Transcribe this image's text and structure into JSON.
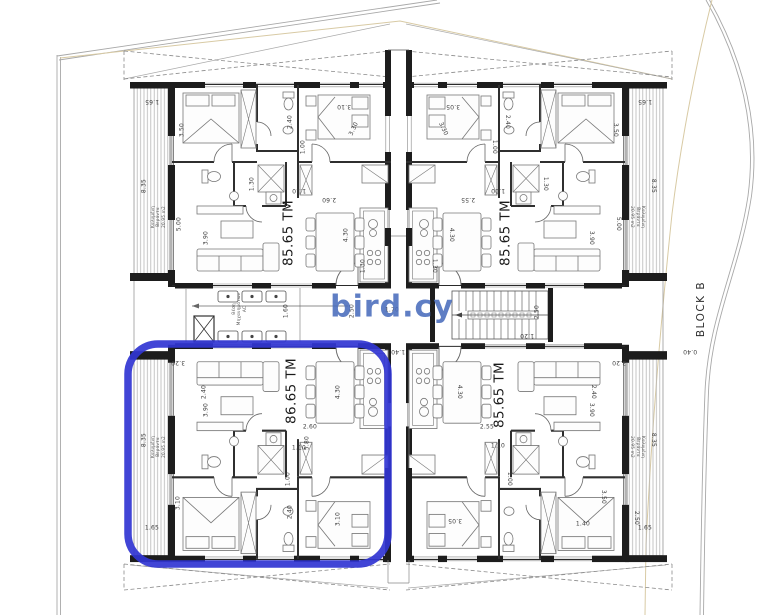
{
  "watermark": {
    "text": "bird.cy",
    "color": "#4a6dbd"
  },
  "site": {
    "block_label": "BLOCK B"
  },
  "highlight": {
    "color": "#3135d2"
  },
  "units": [
    {
      "id": "top-left",
      "area_label": "85.65 TM",
      "balcony_label": "Καλυμένη Βεράντα 20.95 m2",
      "highlighted": false
    },
    {
      "id": "top-right",
      "area_label": "85.65 TM",
      "balcony_label": "Καλυμένη Βεράντα 20.95 m2",
      "highlighted": false
    },
    {
      "id": "bottom-left",
      "area_label": "86.65 TM",
      "balcony_label": "Καλυμένη Βεράντα 20.95 m2",
      "highlighted": true
    },
    {
      "id": "bottom-right",
      "area_label": "85.65 TM",
      "balcony_label": "Καλυμένη Βεράντα 20.95 m2",
      "highlighted": false
    }
  ],
  "core": {
    "ac_area_label": "Θέση Μηχανημάτων AC"
  },
  "labels": [
    {
      "name": "area-label-top-left",
      "cls": "area",
      "text": "85.65 TM",
      "x": 289,
      "y": 233,
      "r": -90,
      "s": 13.5,
      "w": 500
    },
    {
      "name": "area-label-top-right",
      "cls": "area",
      "text": "85.65 TM",
      "x": 506,
      "y": 233,
      "r": -90,
      "s": 13.5,
      "w": 500
    },
    {
      "name": "area-label-bottom-left",
      "cls": "area",
      "text": "86.65 TM",
      "x": 292,
      "y": 391,
      "r": -90,
      "s": 13.5,
      "w": 500
    },
    {
      "name": "area-label-bottom-right",
      "cls": "area",
      "text": "85.65 TM",
      "x": 500,
      "y": 395,
      "r": -90,
      "s": 13.5,
      "w": 500
    },
    {
      "name": "balcony-label",
      "cls": "tiny",
      "lines": [
        "Καλυμένη",
        "Βεράντα",
        "20.95 m2"
      ],
      "x": 158,
      "y": 217,
      "r": -90,
      "s": 4.2
    },
    {
      "name": "balcony-label",
      "cls": "tiny",
      "lines": [
        "Καλυμένη",
        "Βεράντα",
        "20.95 m2"
      ],
      "x": 638,
      "y": 217,
      "r": 90,
      "s": 4.2
    },
    {
      "name": "balcony-label",
      "cls": "tiny",
      "lines": [
        "Καλυμένη",
        "Βεράντα",
        "20.95 m2"
      ],
      "x": 158,
      "y": 447,
      "r": -90,
      "s": 4.2
    },
    {
      "name": "balcony-label",
      "cls": "tiny",
      "lines": [
        "Καλυμένη",
        "Βεράντα",
        "20.95 m2"
      ],
      "x": 638,
      "y": 447,
      "r": 90,
      "s": 4.2
    },
    {
      "name": "ac-area-label",
      "cls": "tiny",
      "lines": [
        "Θέση",
        "Μηχανημάτων",
        "AC"
      ],
      "x": 239,
      "y": 309,
      "r": -90,
      "s": 4.2
    },
    {
      "text": "1.65",
      "x": 152,
      "y": 101,
      "r": 180
    },
    {
      "text": "3.50",
      "x": 182,
      "y": 130,
      "r": -90
    },
    {
      "text": "8.35",
      "x": 144,
      "y": 186,
      "r": -90
    },
    {
      "text": "5.00",
      "x": 179,
      "y": 224,
      "r": -90
    },
    {
      "text": "3.90",
      "x": 206,
      "y": 238,
      "r": -90
    },
    {
      "text": "2.40",
      "x": 290,
      "y": 122,
      "r": -90
    },
    {
      "text": "1.00",
      "x": 303,
      "y": 147,
      "r": -90
    },
    {
      "text": "3.10",
      "x": 344,
      "y": 106,
      "r": 180
    },
    {
      "text": "3.30",
      "x": 354,
      "y": 129,
      "r": -65
    },
    {
      "text": "1.30",
      "x": 252,
      "y": 184,
      "r": -90
    },
    {
      "text": "1.10",
      "x": 299,
      "y": 190,
      "r": 180
    },
    {
      "text": "2.60",
      "x": 329,
      "y": 199,
      "r": 180
    },
    {
      "text": "4.30",
      "x": 346,
      "y": 235,
      "r": -90
    },
    {
      "text": "1.30",
      "x": 363,
      "y": 266,
      "r": -90
    },
    {
      "text": "1.65",
      "x": 645,
      "y": 101,
      "r": 180
    },
    {
      "text": "3.50",
      "x": 615,
      "y": 130,
      "r": 90
    },
    {
      "text": "8.35",
      "x": 653,
      "y": 186,
      "r": 90
    },
    {
      "text": "5.00",
      "x": 618,
      "y": 224,
      "r": 90
    },
    {
      "text": "3.90",
      "x": 591,
      "y": 238,
      "r": 90
    },
    {
      "text": "2.40",
      "x": 507,
      "y": 122,
      "r": 90
    },
    {
      "text": "1.00",
      "x": 494,
      "y": 147,
      "r": 90
    },
    {
      "text": "3.05",
      "x": 453,
      "y": 106,
      "r": 180
    },
    {
      "text": "3.30",
      "x": 443,
      "y": 129,
      "r": 65
    },
    {
      "text": "1.30",
      "x": 545,
      "y": 184,
      "r": 90
    },
    {
      "text": "1.10",
      "x": 498,
      "y": 190,
      "r": 180
    },
    {
      "text": "2.55",
      "x": 468,
      "y": 199,
      "r": 180
    },
    {
      "text": "4.30",
      "x": 451,
      "y": 235,
      "r": 90
    },
    {
      "text": "1.30",
      "x": 434,
      "y": 266,
      "r": 90
    },
    {
      "text": "1.60",
      "x": 286,
      "y": 311,
      "r": -90
    },
    {
      "text": "2.50",
      "x": 352,
      "y": 311,
      "r": -90
    },
    {
      "text": "1.70",
      "x": 392,
      "y": 310,
      "r": 0
    },
    {
      "text": "1.40",
      "x": 398,
      "y": 351,
      "r": 180
    },
    {
      "text": "2.50",
      "x": 537,
      "y": 312,
      "r": -90
    },
    {
      "text": "1.20",
      "x": 527,
      "y": 335,
      "r": 180
    },
    {
      "text": "0.40",
      "x": 690,
      "y": 351,
      "r": 180
    },
    {
      "text": "3.20",
      "x": 178,
      "y": 362,
      "r": 180
    },
    {
      "text": "2.40",
      "x": 204,
      "y": 392,
      "r": -90
    },
    {
      "text": "8.35",
      "x": 144,
      "y": 440,
      "r": -90
    },
    {
      "text": "3.10",
      "x": 178,
      "y": 503,
      "r": -90
    },
    {
      "text": "1.65",
      "x": 152,
      "y": 528,
      "r": 0
    },
    {
      "text": "4.30",
      "x": 338,
      "y": 392,
      "r": -90
    },
    {
      "text": "2.60",
      "x": 310,
      "y": 427,
      "r": 0
    },
    {
      "text": "5.80",
      "x": 307,
      "y": 443,
      "r": -90
    },
    {
      "text": "1.10",
      "x": 299,
      "y": 448,
      "r": 0
    },
    {
      "text": "1.00",
      "x": 288,
      "y": 479,
      "r": -90
    },
    {
      "text": "3.10",
      "x": 338,
      "y": 519,
      "r": -90
    },
    {
      "text": "2.40",
      "x": 290,
      "y": 512,
      "r": -90
    },
    {
      "text": "3.90",
      "x": 206,
      "y": 410,
      "r": -90
    },
    {
      "text": "3.20",
      "x": 619,
      "y": 362,
      "r": 180
    },
    {
      "text": "2.40",
      "x": 593,
      "y": 392,
      "r": 90
    },
    {
      "text": "8.35",
      "x": 653,
      "y": 440,
      "r": 90
    },
    {
      "text": "3.50",
      "x": 603,
      "y": 497,
      "r": 90
    },
    {
      "text": "1.65",
      "x": 645,
      "y": 528,
      "r": 0
    },
    {
      "text": "2.50",
      "x": 636,
      "y": 518,
      "r": 90
    },
    {
      "text": "4.30",
      "x": 459,
      "y": 392,
      "r": 90
    },
    {
      "text": "2.55",
      "x": 487,
      "y": 427,
      "r": 0
    },
    {
      "text": "1.10",
      "x": 498,
      "y": 446,
      "r": 0
    },
    {
      "text": "1.00",
      "x": 509,
      "y": 479,
      "r": 90
    },
    {
      "text": "3.05",
      "x": 455,
      "y": 520,
      "r": 180
    },
    {
      "text": "1.40",
      "x": 583,
      "y": 524,
      "r": 0
    },
    {
      "text": "3.90",
      "x": 591,
      "y": 410,
      "r": 90
    }
  ]
}
